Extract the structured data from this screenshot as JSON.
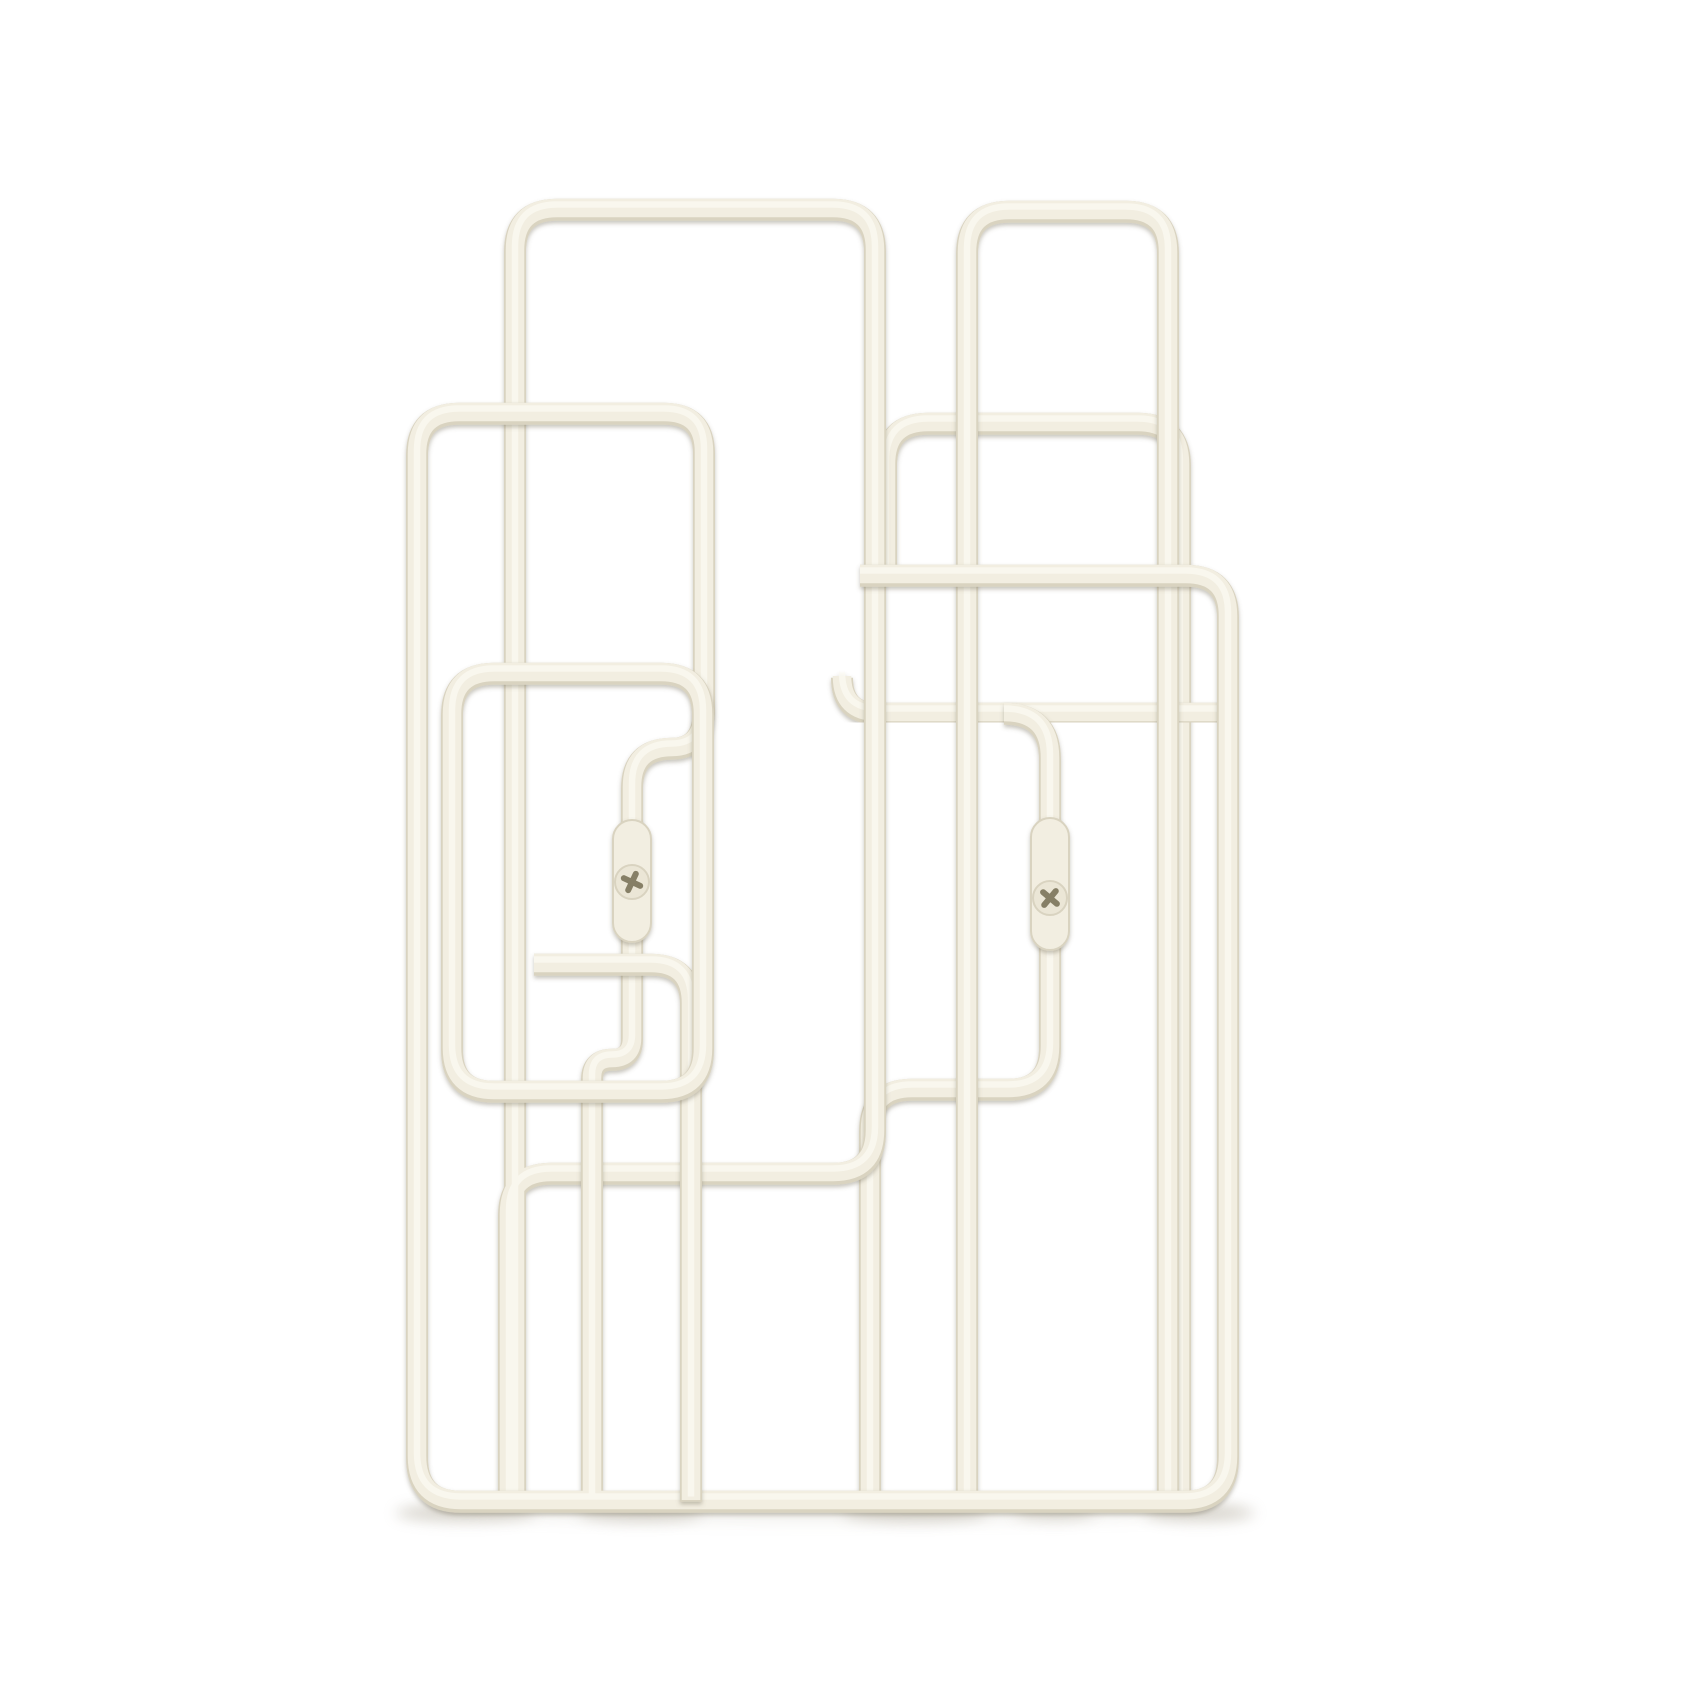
{
  "scene": {
    "kind": "product-photo",
    "subject": "wall-mounted-wire-magazine-rack",
    "background": "plain white studio background",
    "visible_text": "none"
  },
  "canvas": {
    "width": 1701,
    "height": 1702,
    "view_box": "0 0 1701 1702"
  },
  "colors": {
    "background": "#ffffff",
    "wire_main": "#f2eee1",
    "wire_shade": "#d9d3c0",
    "wire_highlight": "#fbf9f1",
    "cast_shadow": "#6e6650",
    "ground_shadow": "#b5afa0",
    "screw": "#ebe6d6",
    "screw_slot": "#867f66"
  },
  "wires": [
    {
      "name": "back-right-loop",
      "d": "M 886,576 L 886,464 Q 886,422 928,422 L 1138,422 Q 1180,422 1180,464 L 1180,1500"
    },
    {
      "name": "right-pocket-rail",
      "d": "M 842,676 Q 842,712 878,712 L 1218,712"
    },
    {
      "name": "right-mount-wire",
      "d": "M 1004,712 Q 1050,712 1050,758 L 1050,1046 Q 1050,1088 1008,1088 L 912,1088 Q 870,1088 870,1130 L 870,1500"
    },
    {
      "name": "right-tall-loop",
      "d": "M 967,1500 L 967,252 Q 967,210 1009,210 L 1126,210 Q 1168,210 1168,252 L 1168,1500"
    },
    {
      "name": "left-tall-loop",
      "d": "M 515,1500 L 515,250 Q 515,208 557,208 L 833,208 Q 875,208 875,250 L 875,1130 Q 875,1172 833,1172 L 551,1172 Q 509,1172 509,1214 L 509,1500"
    },
    {
      "name": "outer-frame-loop",
      "d": "M 592,1500 L 592,1078 Q 592,1058 612,1058 Q 632,1058 632,1038 L 632,787 Q 632,747 672,747 Q 704,747 704,707 L 704,452 Q 704,412 664,412 L 459,412 Q 417,412 417,454 L 417,1456 Q 417,1500 461,1500 L 1184,1500 Q 1228,1500 1228,1456 L 1228,616 Q 1228,574 1186,574 L 860,574"
    },
    {
      "name": "left-pocket-rail",
      "d": "M 534,963 L 651,963 Q 691,963 691,1003 L 691,1500"
    },
    {
      "name": "left-pocket-frame",
      "d": "M 494,672 L 661,672 Q 703,672 703,714 L 703,1048 Q 703,1090 661,1090 L 494,1090 Q 452,1090 452,1048 L 452,714 Q 452,672 494,672 Z"
    }
  ],
  "mounts": [
    {
      "name": "mount-plate-left",
      "x": 613,
      "y": 820,
      "width": 38,
      "height": 122,
      "rx": 19,
      "screw": {
        "cx": 632,
        "cy": 882,
        "r": 17,
        "angle": 25
      }
    },
    {
      "name": "mount-plate-right",
      "x": 1031,
      "y": 818,
      "width": 38,
      "height": 132,
      "rx": 19,
      "screw": {
        "cx": 1050,
        "cy": 898,
        "r": 17,
        "angle": 40
      }
    }
  ],
  "ground_shadows": [
    {
      "cx": 823,
      "cy": 1512,
      "rx": 420,
      "ry": 11,
      "opacity": 0.16
    },
    {
      "cx": 465,
      "cy": 1513,
      "rx": 70,
      "ry": 9,
      "opacity": 0.45
    },
    {
      "cx": 640,
      "cy": 1513,
      "rx": 62,
      "ry": 9,
      "opacity": 0.42
    },
    {
      "cx": 915,
      "cy": 1513,
      "rx": 72,
      "ry": 9,
      "opacity": 0.45
    },
    {
      "cx": 1055,
      "cy": 1513,
      "rx": 40,
      "ry": 8,
      "opacity": 0.35
    },
    {
      "cx": 1200,
      "cy": 1513,
      "rx": 55,
      "ry": 9,
      "opacity": 0.45
    }
  ]
}
